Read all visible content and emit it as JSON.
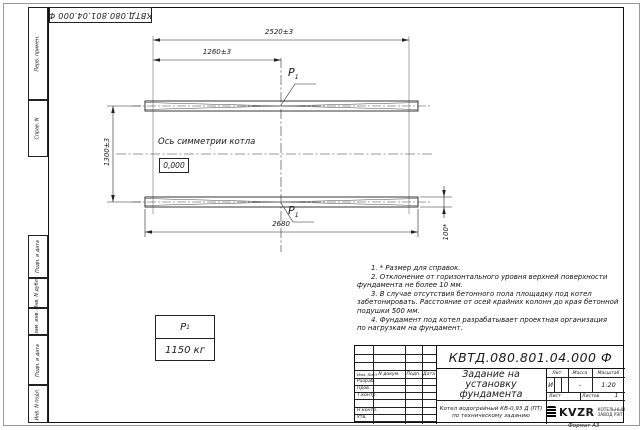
{
  "sheet": {
    "top_stamp": "КВТД.080.801.04.000  Ф",
    "format_label": "Формат А3",
    "margin_labels": [
      "Перв. примен.",
      "Справ. N",
      "Подп. и дата",
      "Инв. N дубл.",
      "Взам. инв. N",
      "Подп. и дата",
      "Инв. N подл."
    ]
  },
  "drawing": {
    "dim_top_full": "2520±3",
    "dim_top_half": "1260±3",
    "dim_left": "1300±3",
    "dim_bottom": "2680",
    "dim_height": "100*",
    "axis_label": "Ось симметрии котла",
    "elevation_mark": "0,000",
    "load_symbol": "P",
    "load_sub": "1",
    "load_value": "1150 кг"
  },
  "notes": {
    "lines": [
      "1. * Размер для справок.",
      "2. Отклонение от горизонтального уровня верхней поверхности",
      "фундамента не более 10 мм.",
      "3. В случае отсутствия бетонного пола площадку под котел",
      "забетонировать. Расстояние от осей крайних колонн до края бетонной",
      "подушки 500 мм.",
      "4. Фундамент под котел разрабатывает проектная организация",
      "по нагрузкам на фундамент."
    ]
  },
  "title_block": {
    "designation": "КВТД.080.801.04.000  Ф",
    "doc_title_l1": "Задание на",
    "doc_title_l2": "установку",
    "doc_title_l3": "фундамента",
    "product_l1": "Котел водогрейный КВ-0,93 Д (ПТ)",
    "product_l2": "по техническому заданию",
    "col_izm": "Изм. Лист",
    "col_doc": "N докум.",
    "col_podp": "Подп.",
    "col_data": "Дата",
    "row_razrab": "Разраб.",
    "row_prov": "Пров.",
    "row_tkontr": "Т.контр.",
    "row_nkontr": "Н.контр.",
    "row_utv": "Утв.",
    "lit_header": "Лит.",
    "mass_header": "Масса",
    "scale_header": "Масштаб",
    "lit_value": "И",
    "mass_value": "-",
    "scale_value": "1:20",
    "sheet_label": "Лист",
    "sheets_label": "Листов",
    "sheets_value": "1",
    "logo_text": "KVZR",
    "logo_caption_l1": "КОТЕЛЬНЫЙ",
    "logo_caption_l2": "ЗАВОД РЭП"
  }
}
